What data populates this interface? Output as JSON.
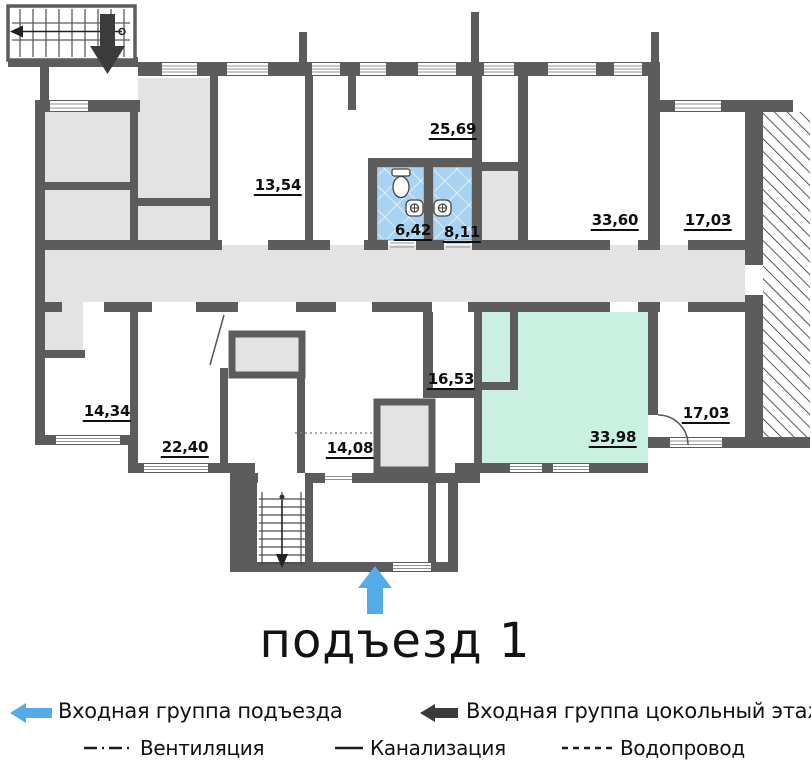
{
  "title": "подъезд 1",
  "rooms": [
    {
      "name": "room-25-69",
      "area": "25,69"
    },
    {
      "name": "room-13-54",
      "area": "13,54"
    },
    {
      "name": "room-6-42",
      "area": "6,42"
    },
    {
      "name": "room-8-11",
      "area": "8,11"
    },
    {
      "name": "room-33-60",
      "area": "33,60"
    },
    {
      "name": "room-17-03-top",
      "area": "17,03"
    },
    {
      "name": "room-14-34",
      "area": "14,34"
    },
    {
      "name": "room-22-40",
      "area": "22,40"
    },
    {
      "name": "room-14-08",
      "area": "14,08"
    },
    {
      "name": "room-16-53",
      "area": "16,53"
    },
    {
      "name": "room-33-98",
      "area": "33,98"
    },
    {
      "name": "room-17-03-bottom",
      "area": "17,03"
    }
  ],
  "legend": {
    "entrance_main": "Входная группа подъезда",
    "entrance_basement": "Входная группа цокольный этаж",
    "ventilation": "Вентиляция",
    "sewerage": "Канализация",
    "water_supply": "Водопровод"
  },
  "colors": {
    "wall": "#5c5c5c",
    "floor_gray": "#e3e3e3",
    "room_green": "#c9f0e1",
    "tile_blue": "#a8d2f1",
    "arrow_blue": "#55abe8",
    "arrow_dark": "#3b3b3b"
  }
}
